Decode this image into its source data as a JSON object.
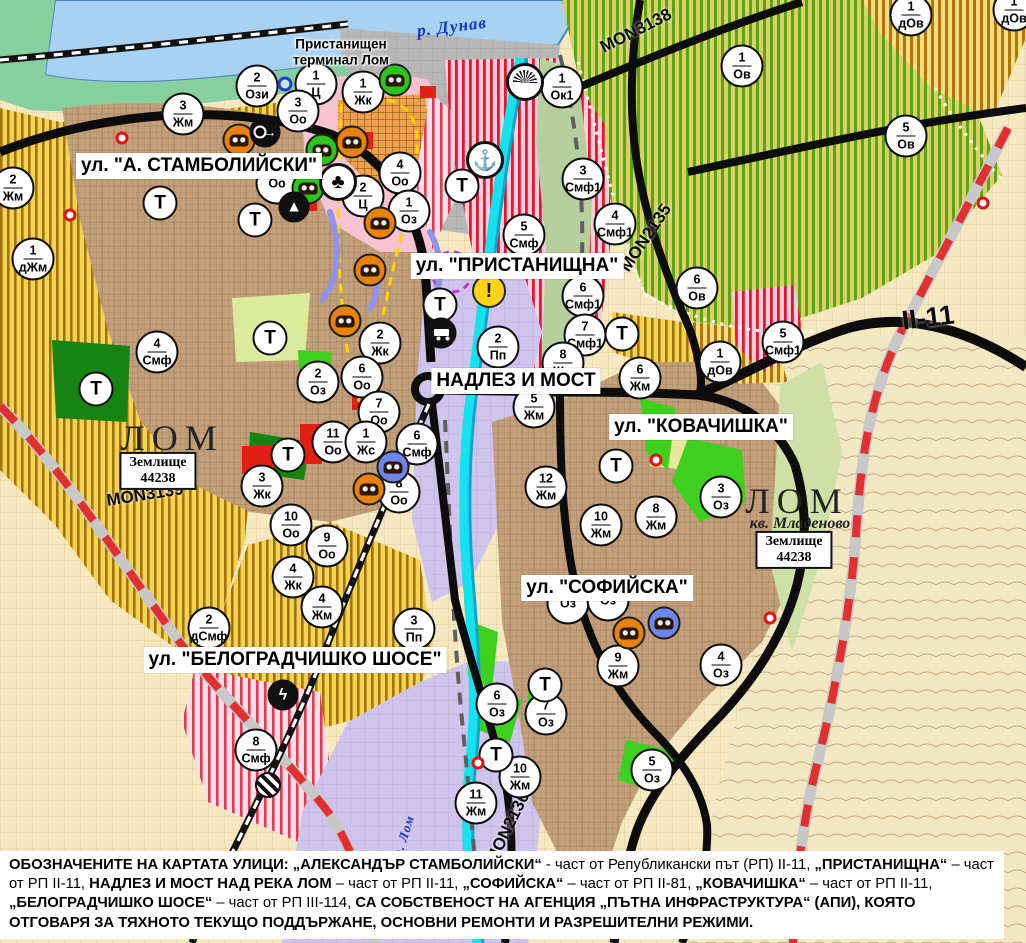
{
  "colors": {
    "water": "#a9d2f2",
    "river_lom": "#14e2ee",
    "road": "#0c0c0c",
    "roadworks_dash": "#e23030",
    "residential_brown": "#c3a07a",
    "mixed_use_stripe": "#df1830",
    "vineyard_stripe": "#5ca414",
    "farmland_yellow": "#f4d252",
    "industrial_lavender": "#cfc4ec",
    "green_area": "#3fd01f"
  },
  "rivers": {
    "danube": "р. Дунав",
    "lom": "р. Лом"
  },
  "port_terminal": {
    "line1": "Пристанищен",
    "line2": "терминал Лом"
  },
  "city": {
    "west": {
      "name": "ЛОМ",
      "plot_label": "Землище",
      "plot_code": "44238"
    },
    "east": {
      "name": "ЛОМ",
      "district": "кв. Младеново",
      "plot_label": "Землище",
      "plot_code": "44238"
    }
  },
  "street_labels": [
    {
      "text": "ул. \"А. СТАМБОЛИЙСКИ\"",
      "x": 199,
      "y": 166
    },
    {
      "text": "ул. \"ПРИСТАНИЩНА\"",
      "x": 517,
      "y": 266
    },
    {
      "text": "НАДЛЕЗ И МОСТ",
      "x": 516,
      "y": 381
    },
    {
      "text": "ул. \"КОВАЧИШКА\"",
      "x": 701,
      "y": 427
    },
    {
      "text": "ул. \"СОФИЙСКА\"",
      "x": 607,
      "y": 588
    },
    {
      "text": "ул. \"БЕЛОГРАДЧИШКО ШОСЕ\"",
      "x": 295,
      "y": 660
    }
  ],
  "road_labels": [
    {
      "text": "MON3138",
      "x": 636,
      "y": 31,
      "rot": -27
    },
    {
      "text": "MON2135",
      "x": 646,
      "y": 238,
      "rot": -56
    },
    {
      "text": "MON3139",
      "x": 145,
      "y": 495,
      "rot": -9
    },
    {
      "text": "MON2136",
      "x": 508,
      "y": 828,
      "rot": -64
    },
    {
      "text": "II-11",
      "x": 928,
      "y": 318,
      "rot": -7,
      "cls": "xl"
    }
  ],
  "markers": [
    {
      "n": "2",
      "c": "Жм",
      "x": 13,
      "y": 188
    },
    {
      "n": "3",
      "c": "Жм",
      "x": 183,
      "y": 114
    },
    {
      "n": "2",
      "c": "Ози",
      "x": 257,
      "y": 86
    },
    {
      "n": "1",
      "c": "Ц",
      "x": 316,
      "y": 84
    },
    {
      "n": "3",
      "c": "Оо",
      "x": 298,
      "y": 111
    },
    {
      "n": "1",
      "c": "Жк",
      "x": 363,
      "y": 92
    },
    {
      "n": "4",
      "c": "Оо",
      "x": 400,
      "y": 173
    },
    {
      "n": "",
      "c": "Оо",
      "x": 277,
      "y": 183
    },
    {
      "n": "2",
      "c": "Ц",
      "x": 363,
      "y": 196
    },
    {
      "n": "1",
      "c": "Оз",
      "x": 409,
      "y": 211
    },
    {
      "n": "1",
      "c": "дЖм",
      "x": 33,
      "y": 259
    },
    {
      "n": "4",
      "c": "Смф",
      "x": 157,
      "y": 352
    },
    {
      "n": "2",
      "c": "Оз",
      "x": 318,
      "y": 382
    },
    {
      "n": "2",
      "c": "Жк",
      "x": 380,
      "y": 343
    },
    {
      "n": "6",
      "c": "Оо",
      "x": 362,
      "y": 377
    },
    {
      "n": "7",
      "c": "Оо",
      "x": 379,
      "y": 412
    },
    {
      "n": "11",
      "c": "Оо",
      "x": 333,
      "y": 442
    },
    {
      "n": "1",
      "c": "Жс",
      "x": 366,
      "y": 442
    },
    {
      "n": "6",
      "c": "Смф",
      "x": 417,
      "y": 444
    },
    {
      "n": "8",
      "c": "Оо",
      "x": 399,
      "y": 492
    },
    {
      "n": "3",
      "c": "Жк",
      "x": 262,
      "y": 486
    },
    {
      "n": "10",
      "c": "Оо",
      "x": 291,
      "y": 525
    },
    {
      "n": "9",
      "c": "Оо",
      "x": 327,
      "y": 546
    },
    {
      "n": "4",
      "c": "Жк",
      "x": 293,
      "y": 577
    },
    {
      "n": "4",
      "c": "Жм",
      "x": 322,
      "y": 607
    },
    {
      "n": "2",
      "c": "дСмф",
      "x": 209,
      "y": 628
    },
    {
      "n": "8",
      "c": "Смф",
      "x": 256,
      "y": 750
    },
    {
      "n": "3",
      "c": "Пп",
      "x": 414,
      "y": 629
    },
    {
      "n": "1",
      "c": "Ок1",
      "x": 562,
      "y": 87
    },
    {
      "n": "3",
      "c": "Смф1",
      "x": 583,
      "y": 179
    },
    {
      "n": "5",
      "c": "Смф",
      "x": 524,
      "y": 235
    },
    {
      "n": "4",
      "c": "Смф1",
      "x": 615,
      "y": 224
    },
    {
      "n": "6",
      "c": "Смф1",
      "x": 583,
      "y": 296
    },
    {
      "n": "7",
      "c": "Смф1",
      "x": 585,
      "y": 335
    },
    {
      "n": "2",
      "c": "Пп",
      "x": 498,
      "y": 347
    },
    {
      "n": "8",
      "c": "Жм",
      "x": 563,
      "y": 363
    },
    {
      "n": "5",
      "c": "Жм",
      "x": 534,
      "y": 407
    },
    {
      "n": "6",
      "c": "Жм",
      "x": 640,
      "y": 378
    },
    {
      "n": "12",
      "c": "Жм",
      "x": 546,
      "y": 487
    },
    {
      "n": "10",
      "c": "Жм",
      "x": 601,
      "y": 525
    },
    {
      "n": "8",
      "c": "Жм",
      "x": 656,
      "y": 517
    },
    {
      "n": "3",
      "c": "Оз",
      "x": 721,
      "y": 497
    },
    {
      "n": "6",
      "c": "Ов",
      "x": 697,
      "y": 288
    },
    {
      "n": "1",
      "c": "дОв",
      "x": 720,
      "y": 362
    },
    {
      "n": "5",
      "c": "Смф1",
      "x": 783,
      "y": 342
    },
    {
      "n": "1",
      "c": "Ов",
      "x": 742,
      "y": 66
    },
    {
      "n": "5",
      "c": "Ов",
      "x": 906,
      "y": 136
    },
    {
      "n": "1",
      "c": "дОв",
      "x": 911,
      "y": 15
    },
    {
      "n": "1",
      "c": "дОв",
      "x": 1014,
      "y": 10
    },
    {
      "n": "9",
      "c": "Жм",
      "x": 618,
      "y": 666
    },
    {
      "n": "4",
      "c": "Оз",
      "x": 721,
      "y": 665
    },
    {
      "n": "6",
      "c": "Оз",
      "x": 497,
      "y": 704
    },
    {
      "n": "7",
      "c": "Оз",
      "x": 546,
      "y": 714
    },
    {
      "n": "10",
      "c": "Жм",
      "x": 520,
      "y": 777
    },
    {
      "n": "11",
      "c": "Жм",
      "x": 476,
      "y": 803
    },
    {
      "n": "5",
      "c": "Оз",
      "x": 652,
      "y": 770
    },
    {
      "n": "",
      "c": "Оз",
      "x": 568,
      "y": 603
    },
    {
      "n": "",
      "c": "Оз",
      "x": 608,
      "y": 600
    },
    {
      "n": "",
      "c": "Т",
      "x": 160,
      "y": 203,
      "cls": "t"
    },
    {
      "n": "",
      "c": "Т",
      "x": 255,
      "y": 220,
      "cls": "t"
    },
    {
      "n": "",
      "c": "Т",
      "x": 270,
      "y": 338,
      "cls": "t"
    },
    {
      "n": "",
      "c": "Т",
      "x": 96,
      "y": 389,
      "cls": "t"
    },
    {
      "n": "",
      "c": "Т",
      "x": 288,
      "y": 455,
      "cls": "t"
    },
    {
      "n": "",
      "c": "Т",
      "x": 440,
      "y": 305,
      "cls": "t"
    },
    {
      "n": "",
      "c": "Т",
      "x": 462,
      "y": 186,
      "cls": "t"
    },
    {
      "n": "",
      "c": "Т",
      "x": 622,
      "y": 334,
      "cls": "t"
    },
    {
      "n": "",
      "c": "Т",
      "x": 616,
      "y": 466,
      "cls": "t"
    },
    {
      "n": "",
      "c": "Т",
      "x": 545,
      "y": 685,
      "cls": "t"
    },
    {
      "n": "",
      "c": "Т",
      "x": 496,
      "y": 755,
      "cls": "t"
    }
  ],
  "symbols": [
    {
      "name": "monument-orange-icon",
      "cls": "machine orange",
      "g": "",
      "x": 239,
      "y": 140
    },
    {
      "name": "monument-orange-icon",
      "cls": "machine orange",
      "g": "",
      "x": 352,
      "y": 142
    },
    {
      "name": "monument-orange-icon",
      "cls": "machine orange",
      "g": "",
      "x": 380,
      "y": 223
    },
    {
      "name": "monument-orange-icon",
      "cls": "machine orange",
      "g": "",
      "x": 370,
      "y": 270
    },
    {
      "name": "monument-orange-icon",
      "cls": "machine orange",
      "g": "",
      "x": 345,
      "y": 321
    },
    {
      "name": "monument-orange-icon",
      "cls": "machine orange",
      "g": "",
      "x": 369,
      "y": 489
    },
    {
      "name": "monument-orange-icon",
      "cls": "machine orange",
      "g": "",
      "x": 629,
      "y": 633
    },
    {
      "name": "monument-green-icon",
      "cls": "machine green",
      "g": "",
      "x": 395,
      "y": 80
    },
    {
      "name": "monument-green-icon",
      "cls": "machine green",
      "g": "",
      "x": 322,
      "y": 150
    },
    {
      "name": "monument-green-icon",
      "cls": "machine green",
      "g": "",
      "x": 308,
      "y": 188
    },
    {
      "name": "monument-blue-icon",
      "cls": "machine blue",
      "g": "",
      "x": 393,
      "y": 467
    },
    {
      "name": "monument-blue-icon",
      "cls": "machine blue",
      "g": "",
      "x": 664,
      "y": 623
    },
    {
      "name": "ring-arrow-icon",
      "cls": "dsym arrowr",
      "g": "",
      "x": 265,
      "y": 132
    },
    {
      "name": "trefoil-icon",
      "cls": "wsym",
      "g": "♣",
      "x": 338,
      "y": 182
    },
    {
      "name": "tumulus-icon",
      "cls": "dsym",
      "g": "▲",
      "x": 294,
      "y": 207
    },
    {
      "name": "sun-fan-icon",
      "cls": "wsym fan",
      "g": "",
      "x": 525,
      "y": 82
    },
    {
      "name": "anchor-icon",
      "cls": "wsym",
      "g": "⚓",
      "x": 485,
      "y": 160
    },
    {
      "name": "truck-terminal-icon",
      "cls": "dsym truck",
      "g": "",
      "x": 441,
      "y": 333
    },
    {
      "name": "warning-icon",
      "cls": "warn",
      "g": "!",
      "x": 489,
      "y": 291
    },
    {
      "name": "lightning-icon",
      "cls": "dsym",
      "g": "ϟ",
      "x": 283,
      "y": 695
    },
    {
      "name": "rail-crossing-icon",
      "cls": "crossing",
      "g": "",
      "x": 268,
      "y": 785
    },
    {
      "name": "blue-ring-icon",
      "cls": "bluering",
      "g": "",
      "x": 285,
      "y": 84
    },
    {
      "name": "red-dot-icon",
      "cls": "reddot",
      "g": "",
      "x": 122,
      "y": 138
    },
    {
      "name": "red-dot-icon",
      "cls": "reddot",
      "g": "",
      "x": 70,
      "y": 215
    },
    {
      "name": "red-dot-icon",
      "cls": "reddot",
      "g": "",
      "x": 656,
      "y": 460
    },
    {
      "name": "red-dot-icon",
      "cls": "reddot",
      "g": "",
      "x": 983,
      "y": 203
    },
    {
      "name": "red-dot-icon",
      "cls": "reddot",
      "g": "",
      "x": 770,
      "y": 618
    },
    {
      "name": "red-dot-icon",
      "cls": "reddot",
      "g": "",
      "x": 478,
      "y": 763
    }
  ],
  "legend": {
    "segments": [
      {
        "text": "ОБОЗНАЧЕНИТЕ НА КАРТАТА УЛИЦИ: „АЛЕКСАНДЪР СТАМБОЛИЙСКИ“",
        "cls": "b"
      },
      {
        "text": " - част от Републикански път (РП) II-11, "
      },
      {
        "text": "„ПРИСТАНИЩНА“",
        "cls": "b"
      },
      {
        "text": " – част от РП II-11, "
      },
      {
        "text": "НАДЛЕЗ И МОСТ НАД РЕКА ЛОМ",
        "cls": "b"
      },
      {
        "text": " – част от РП II-11, "
      },
      {
        "text": "„СОФИЙСКА“",
        "cls": "b"
      },
      {
        "text": " – част от РП II-81, "
      },
      {
        "text": "„КОВАЧИШКА“",
        "cls": "b"
      },
      {
        "text": " – част от РП II-11, "
      },
      {
        "text": "„БЕЛОГРАДЧИШКО ШОСЕ“",
        "cls": "b"
      },
      {
        "text": " – част от РП III-114, "
      },
      {
        "text": "СА СОБСТВЕНОСТ НА АГЕНЦИЯ „ПЪТНА ИНФРАСТРУКТУРА“ (АПИ), КОЯТО ОТГОВАРЯ ЗА ТЯХНОТО ТЕКУЩО ПОДДЪРЖАНЕ, ОСНОВНИ РЕМОНТИ И РАЗРЕШИТЕЛНИ РЕЖИМИ.",
        "cls": "b"
      }
    ]
  }
}
